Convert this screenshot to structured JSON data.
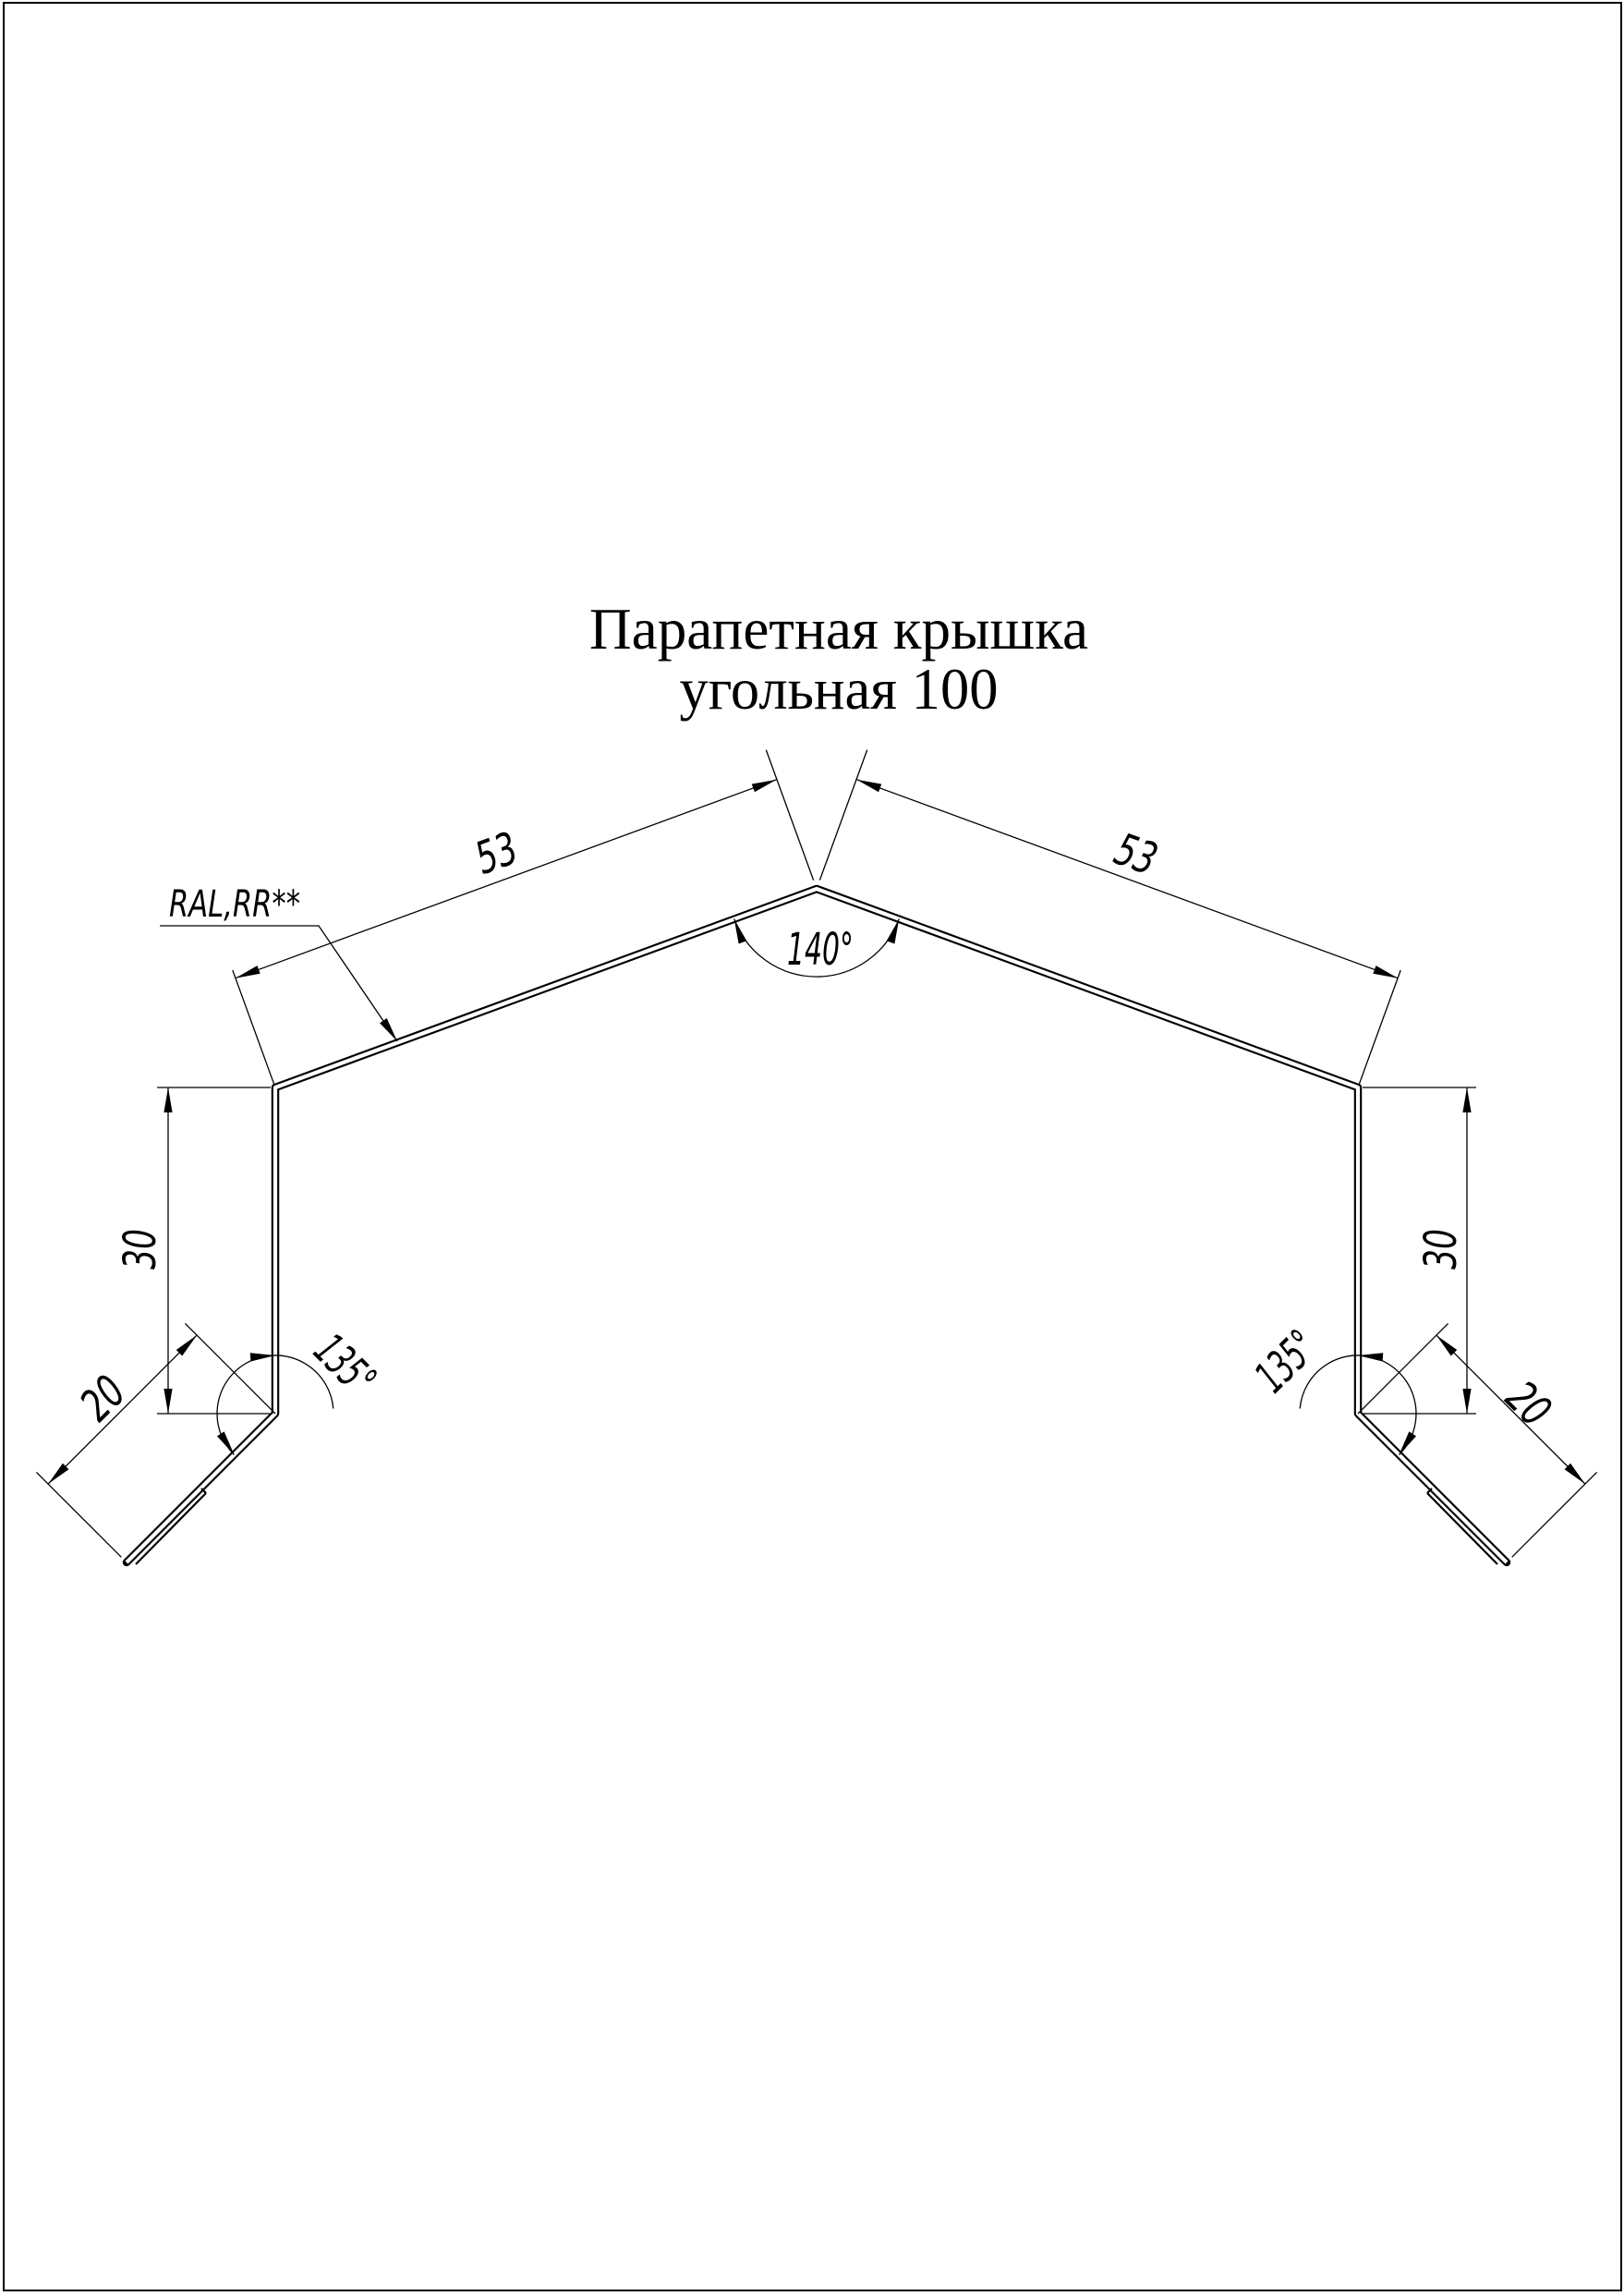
{
  "title": {
    "line1": "Парапетная крышка",
    "line2": "угольная 100"
  },
  "annotations": {
    "material": "RAL,RR**"
  },
  "dimensions": {
    "slope_left": "53",
    "slope_right": "53",
    "apex_angle": "140°",
    "side_left": "30",
    "side_right": "30",
    "hem_left": "20",
    "hem_right": "20",
    "bend_angle_left": "135°",
    "bend_angle_right": "135°"
  },
  "colors": {
    "line": "#000000",
    "background": "#ffffff"
  }
}
